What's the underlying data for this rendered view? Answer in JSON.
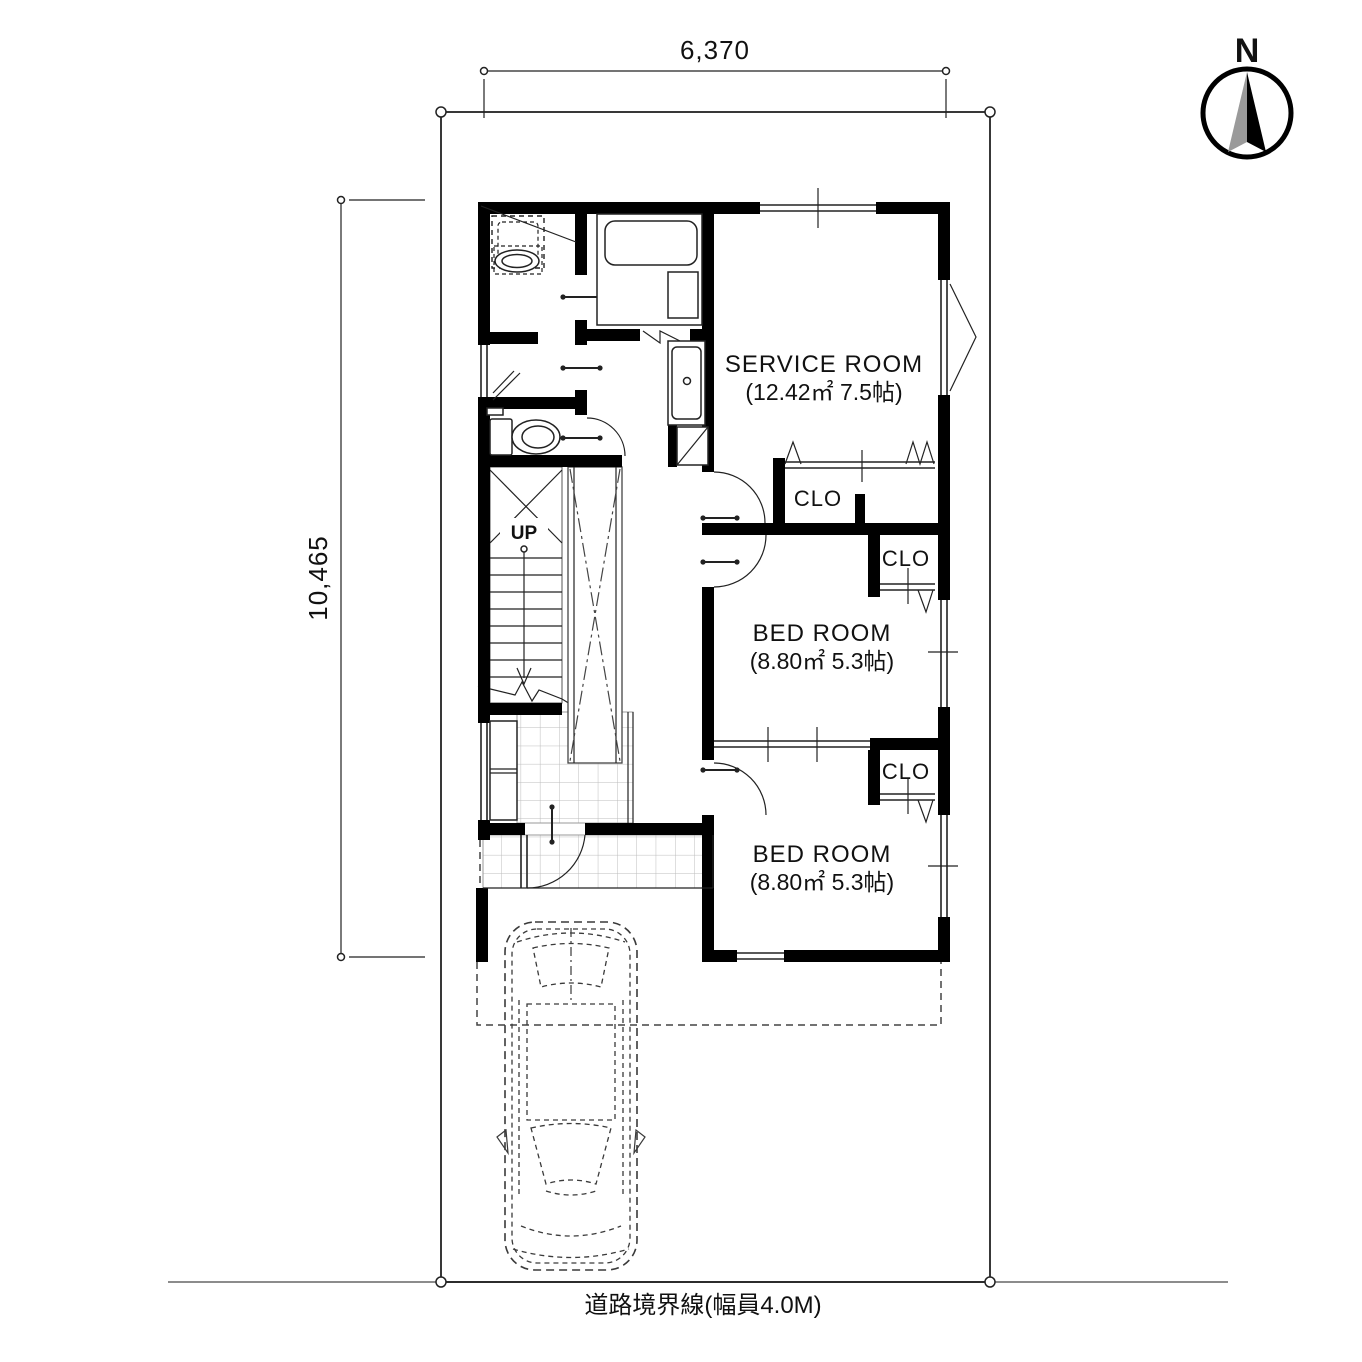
{
  "compass": {
    "label": "N"
  },
  "dimensions": {
    "width_label": "6,370",
    "height_label": "10,465"
  },
  "rooms": {
    "service_room": {
      "name": "SERVICE ROOM",
      "size": "(12.42㎡ 7.5帖)"
    },
    "bedroom1": {
      "name": "BED ROOM",
      "size": "(8.80㎡ 5.3帖)"
    },
    "bedroom2": {
      "name": "BED ROOM",
      "size": "(8.80㎡ 5.3帖)"
    },
    "closet1": {
      "label": "CLO"
    },
    "closet2": {
      "label": "CLO"
    },
    "closet3": {
      "label": "CLO"
    },
    "stairs": {
      "label": "UP"
    }
  },
  "site": {
    "road_boundary_label": "道路境界線(幅員4.0M)"
  },
  "colors": {
    "wall": "#000000",
    "line": "#222222",
    "road_line": "#8c8c8c",
    "tile_line": "#bcbcbc",
    "compass_gray": "#9a9a9a"
  }
}
